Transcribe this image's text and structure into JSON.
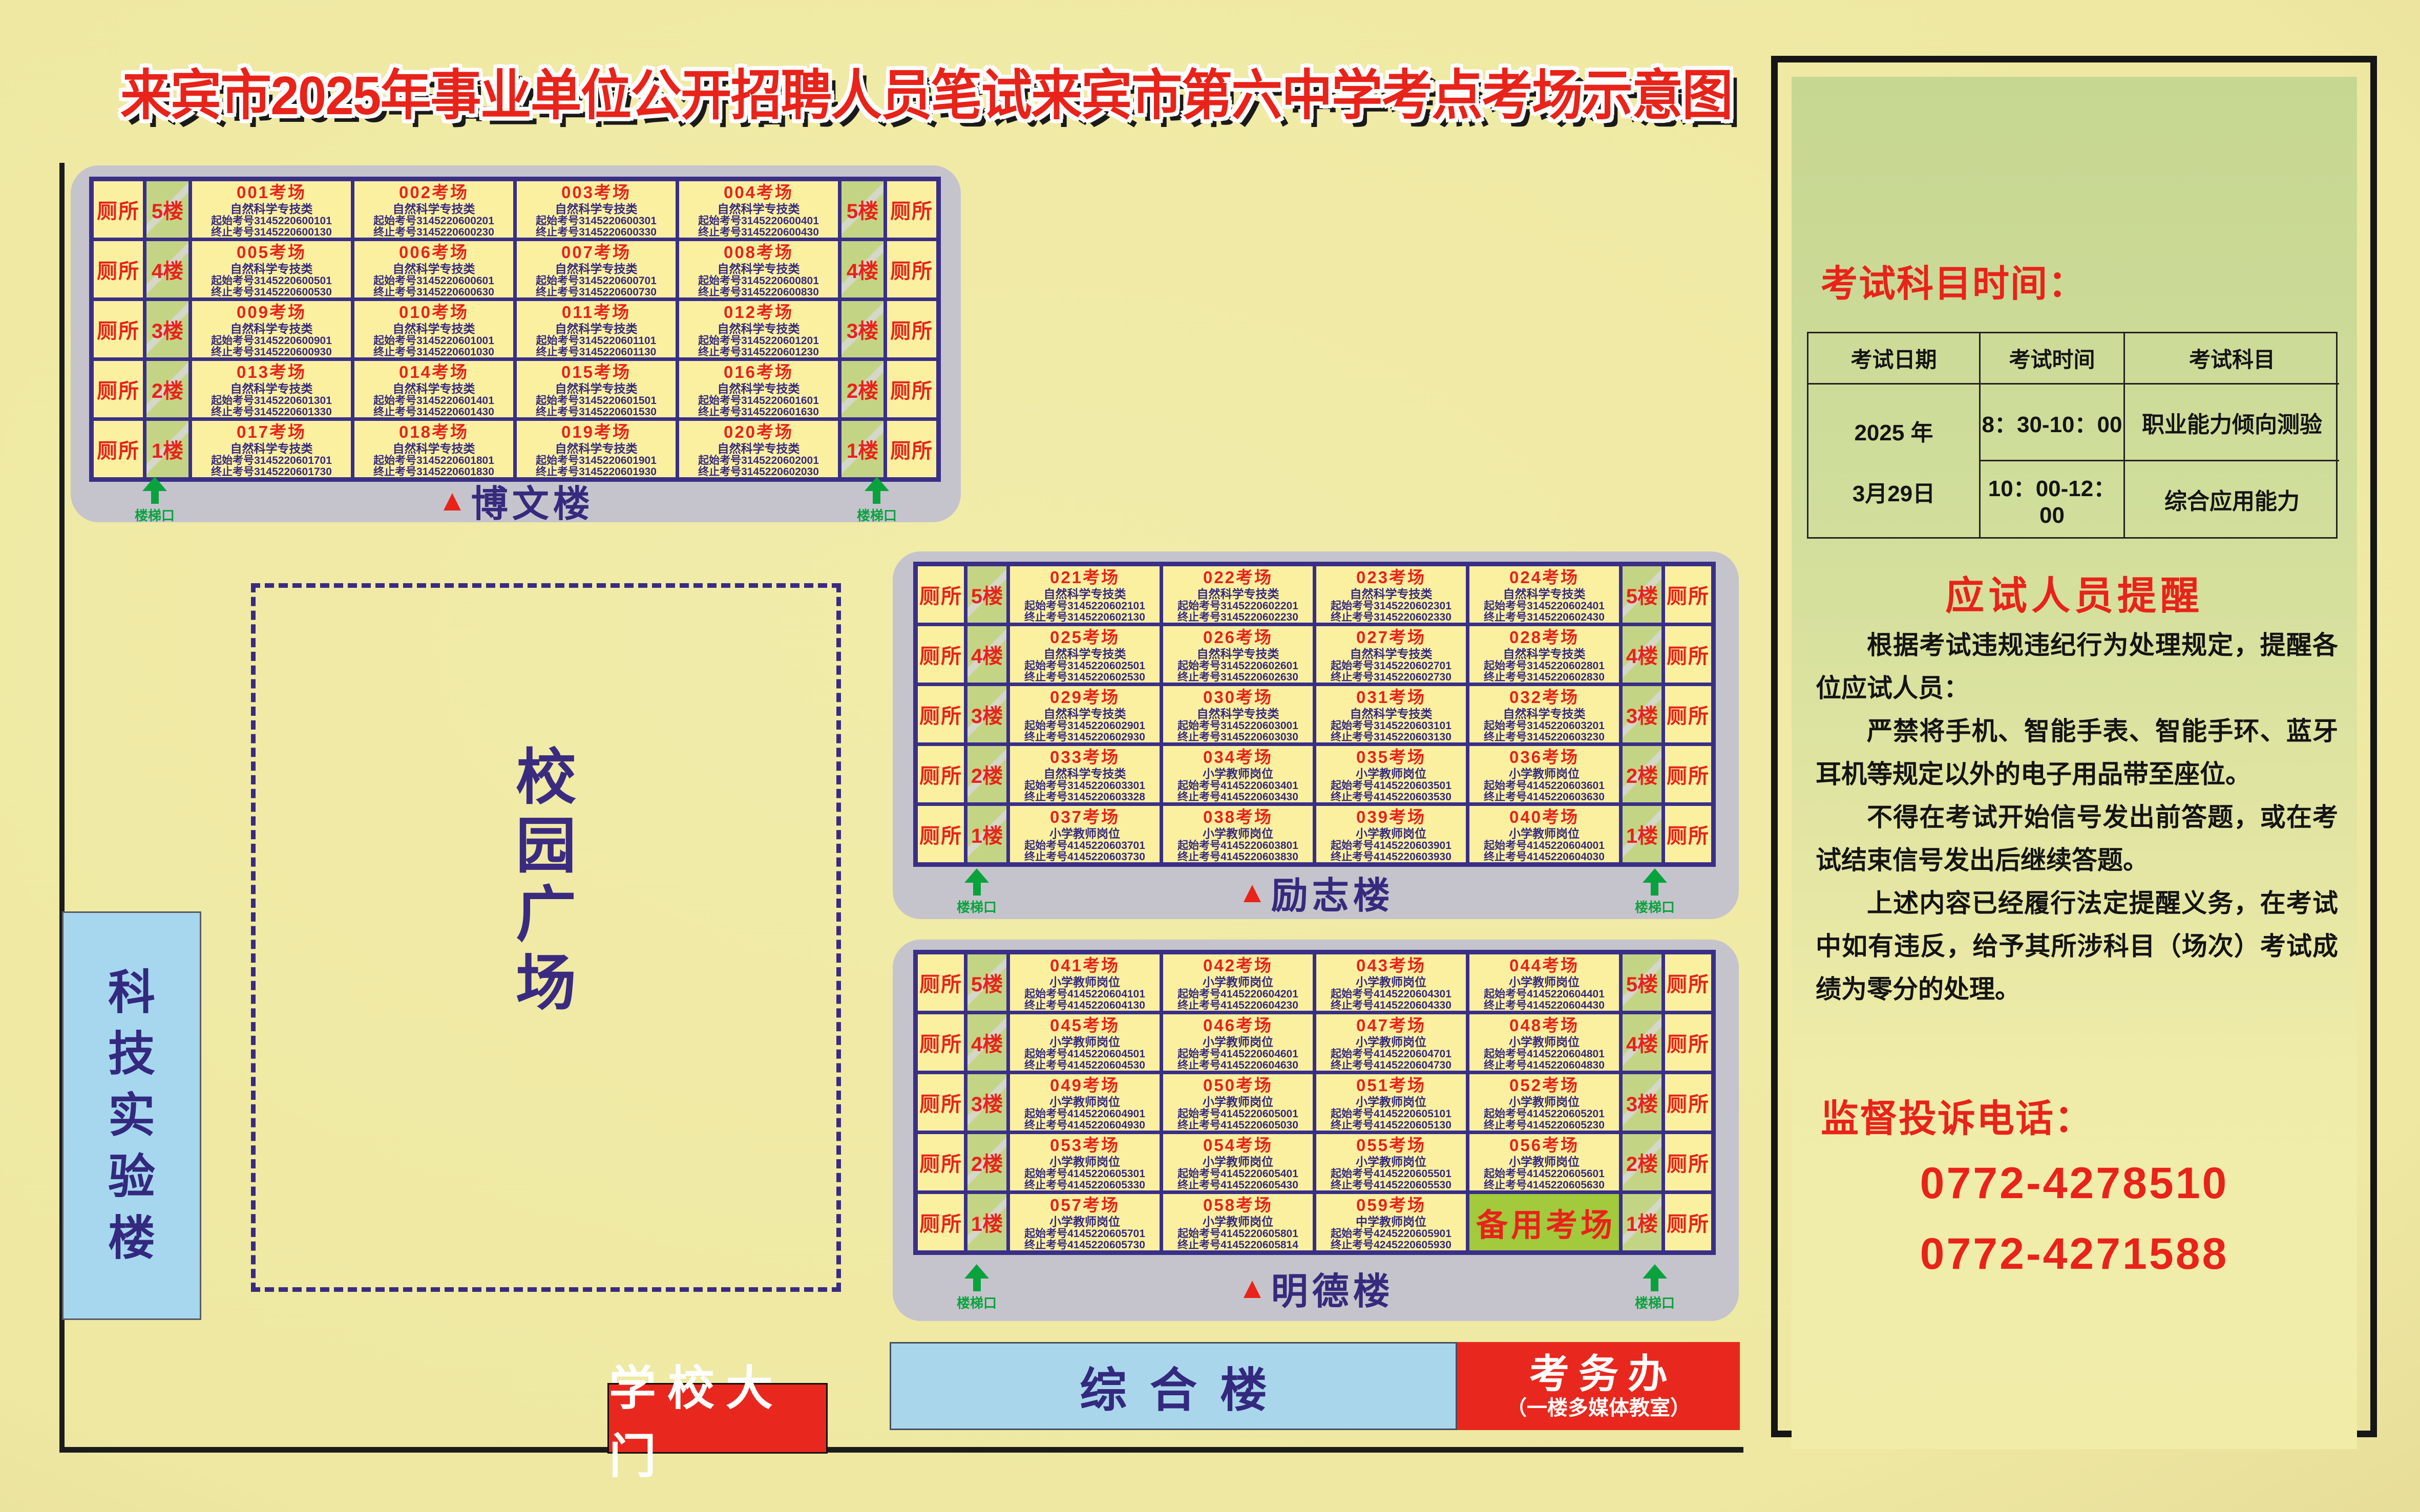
{
  "title": "来宾市2025年事业单位公开招聘人员笔试来宾市第六中学考点考场示意图",
  "map": {
    "plaza_label": "校园广场",
    "science_building_label": "科技实验楼",
    "gate_label": "学校大门",
    "complex_label": "综合楼",
    "exam_office_label": "考务办",
    "exam_office_sub": "（一楼多媒体教室）",
    "toilet_label": "厕所",
    "stair_label": "楼梯口",
    "reserve_room_label": "备用考场",
    "building_marker": "▲"
  },
  "colors": {
    "accent_red": "#e8231a",
    "navy": "#352a7d",
    "cell_yellow": "#fbf0a0",
    "stair_green": "#c3d584",
    "reserve_green": "#a2ca3c",
    "building_gray": "#c5c4cc",
    "arrow_green": "#0aa23d",
    "blue_building": "#aad6ec",
    "panel_green": "#c6d791"
  },
  "buildings": [
    {
      "name": "博文楼",
      "floors": [
        {
          "label": "5楼",
          "rooms": [
            {
              "num": "001考场",
              "cat": "自然科学专技类",
              "start": "起始考号3145220600101",
              "end": "终止考号3145220600130"
            },
            {
              "num": "002考场",
              "cat": "自然科学专技类",
              "start": "起始考号3145220600201",
              "end": "终止考号3145220600230"
            },
            {
              "num": "003考场",
              "cat": "自然科学专技类",
              "start": "起始考号3145220600301",
              "end": "终止考号3145220600330"
            },
            {
              "num": "004考场",
              "cat": "自然科学专技类",
              "start": "起始考号3145220600401",
              "end": "终止考号3145220600430"
            }
          ]
        },
        {
          "label": "4楼",
          "rooms": [
            {
              "num": "005考场",
              "cat": "自然科学专技类",
              "start": "起始考号3145220600501",
              "end": "终止考号3145220600530"
            },
            {
              "num": "006考场",
              "cat": "自然科学专技类",
              "start": "起始考号3145220600601",
              "end": "终止考号3145220600630"
            },
            {
              "num": "007考场",
              "cat": "自然科学专技类",
              "start": "起始考号3145220600701",
              "end": "终止考号3145220600730"
            },
            {
              "num": "008考场",
              "cat": "自然科学专技类",
              "start": "起始考号3145220600801",
              "end": "终止考号3145220600830"
            }
          ]
        },
        {
          "label": "3楼",
          "rooms": [
            {
              "num": "009考场",
              "cat": "自然科学专技类",
              "start": "起始考号3145220600901",
              "end": "终止考号3145220600930"
            },
            {
              "num": "010考场",
              "cat": "自然科学专技类",
              "start": "起始考号3145220601001",
              "end": "终止考号3145220601030"
            },
            {
              "num": "011考场",
              "cat": "自然科学专技类",
              "start": "起始考号3145220601101",
              "end": "终止考号3145220601130"
            },
            {
              "num": "012考场",
              "cat": "自然科学专技类",
              "start": "起始考号3145220601201",
              "end": "终止考号3145220601230"
            }
          ]
        },
        {
          "label": "2楼",
          "rooms": [
            {
              "num": "013考场",
              "cat": "自然科学专技类",
              "start": "起始考号3145220601301",
              "end": "终止考号3145220601330"
            },
            {
              "num": "014考场",
              "cat": "自然科学专技类",
              "start": "起始考号3145220601401",
              "end": "终止考号3145220601430"
            },
            {
              "num": "015考场",
              "cat": "自然科学专技类",
              "start": "起始考号3145220601501",
              "end": "终止考号3145220601530"
            },
            {
              "num": "016考场",
              "cat": "自然科学专技类",
              "start": "起始考号3145220601601",
              "end": "终止考号3145220601630"
            }
          ]
        },
        {
          "label": "1楼",
          "rooms": [
            {
              "num": "017考场",
              "cat": "自然科学专技类",
              "start": "起始考号3145220601701",
              "end": "终止考号3145220601730"
            },
            {
              "num": "018考场",
              "cat": "自然科学专技类",
              "start": "起始考号3145220601801",
              "end": "终止考号3145220601830"
            },
            {
              "num": "019考场",
              "cat": "自然科学专技类",
              "start": "起始考号3145220601901",
              "end": "终止考号3145220601930"
            },
            {
              "num": "020考场",
              "cat": "自然科学专技类",
              "start": "起始考号3145220602001",
              "end": "终止考号3145220602030"
            }
          ]
        }
      ]
    },
    {
      "name": "励志楼",
      "floors": [
        {
          "label": "5楼",
          "rooms": [
            {
              "num": "021考场",
              "cat": "自然科学专技类",
              "start": "起始考号3145220602101",
              "end": "终止考号3145220602130"
            },
            {
              "num": "022考场",
              "cat": "自然科学专技类",
              "start": "起始考号3145220602201",
              "end": "终止考号3145220602230"
            },
            {
              "num": "023考场",
              "cat": "自然科学专技类",
              "start": "起始考号3145220602301",
              "end": "终止考号3145220602330"
            },
            {
              "num": "024考场",
              "cat": "自然科学专技类",
              "start": "起始考号3145220602401",
              "end": "终止考号3145220602430"
            }
          ]
        },
        {
          "label": "4楼",
          "rooms": [
            {
              "num": "025考场",
              "cat": "自然科学专技类",
              "start": "起始考号3145220602501",
              "end": "终止考号3145220602530"
            },
            {
              "num": "026考场",
              "cat": "自然科学专技类",
              "start": "起始考号3145220602601",
              "end": "终止考号3145220602630"
            },
            {
              "num": "027考场",
              "cat": "自然科学专技类",
              "start": "起始考号3145220602701",
              "end": "终止考号3145220602730"
            },
            {
              "num": "028考场",
              "cat": "自然科学专技类",
              "start": "起始考号3145220602801",
              "end": "终止考号3145220602830"
            }
          ]
        },
        {
          "label": "3楼",
          "rooms": [
            {
              "num": "029考场",
              "cat": "自然科学专技类",
              "start": "起始考号3145220602901",
              "end": "终止考号3145220602930"
            },
            {
              "num": "030考场",
              "cat": "自然科学专技类",
              "start": "起始考号3145220603001",
              "end": "终止考号3145220603030"
            },
            {
              "num": "031考场",
              "cat": "自然科学专技类",
              "start": "起始考号3145220603101",
              "end": "终止考号3145220603130"
            },
            {
              "num": "032考场",
              "cat": "自然科学专技类",
              "start": "起始考号3145220603201",
              "end": "终止考号3145220603230"
            }
          ]
        },
        {
          "label": "2楼",
          "rooms": [
            {
              "num": "033考场",
              "cat": "自然科学专技类",
              "start": "起始考号3145220603301",
              "end": "终止考号3145220603328"
            },
            {
              "num": "034考场",
              "cat": "小学教师岗位",
              "start": "起始考号4145220603401",
              "end": "终止考号4145220603430"
            },
            {
              "num": "035考场",
              "cat": "小学教师岗位",
              "start": "起始考号4145220603501",
              "end": "终止考号4145220603530"
            },
            {
              "num": "036考场",
              "cat": "小学教师岗位",
              "start": "起始考号4145220603601",
              "end": "终止考号4145220603630"
            }
          ]
        },
        {
          "label": "1楼",
          "rooms": [
            {
              "num": "037考场",
              "cat": "小学教师岗位",
              "start": "起始考号4145220603701",
              "end": "终止考号4145220603730"
            },
            {
              "num": "038考场",
              "cat": "小学教师岗位",
              "start": "起始考号4145220603801",
              "end": "终止考号4145220603830"
            },
            {
              "num": "039考场",
              "cat": "小学教师岗位",
              "start": "起始考号4145220603901",
              "end": "终止考号4145220603930"
            },
            {
              "num": "040考场",
              "cat": "小学教师岗位",
              "start": "起始考号4145220604001",
              "end": "终止考号4145220604030"
            }
          ]
        }
      ]
    },
    {
      "name": "明德楼",
      "floors": [
        {
          "label": "5楼",
          "rooms": [
            {
              "num": "041考场",
              "cat": "小学教师岗位",
              "start": "起始考号4145220604101",
              "end": "终止考号4145220604130"
            },
            {
              "num": "042考场",
              "cat": "小学教师岗位",
              "start": "起始考号4145220604201",
              "end": "终止考号4145220604230"
            },
            {
              "num": "043考场",
              "cat": "小学教师岗位",
              "start": "起始考号4145220604301",
              "end": "终止考号4145220604330"
            },
            {
              "num": "044考场",
              "cat": "小学教师岗位",
              "start": "起始考号4145220604401",
              "end": "终止考号4145220604430"
            }
          ]
        },
        {
          "label": "4楼",
          "rooms": [
            {
              "num": "045考场",
              "cat": "小学教师岗位",
              "start": "起始考号4145220604501",
              "end": "终止考号4145220604530"
            },
            {
              "num": "046考场",
              "cat": "小学教师岗位",
              "start": "起始考号4145220604601",
              "end": "终止考号4145220604630"
            },
            {
              "num": "047考场",
              "cat": "小学教师岗位",
              "start": "起始考号4145220604701",
              "end": "终止考号4145220604730"
            },
            {
              "num": "048考场",
              "cat": "小学教师岗位",
              "start": "起始考号4145220604801",
              "end": "终止考号4145220604830"
            }
          ]
        },
        {
          "label": "3楼",
          "rooms": [
            {
              "num": "049考场",
              "cat": "小学教师岗位",
              "start": "起始考号4145220604901",
              "end": "终止考号4145220604930"
            },
            {
              "num": "050考场",
              "cat": "小学教师岗位",
              "start": "起始考号4145220605001",
              "end": "终止考号4145220605030"
            },
            {
              "num": "051考场",
              "cat": "小学教师岗位",
              "start": "起始考号4145220605101",
              "end": "终止考号4145220605130"
            },
            {
              "num": "052考场",
              "cat": "小学教师岗位",
              "start": "起始考号4145220605201",
              "end": "终止考号4145220605230"
            }
          ]
        },
        {
          "label": "2楼",
          "rooms": [
            {
              "num": "053考场",
              "cat": "小学教师岗位",
              "start": "起始考号4145220605301",
              "end": "终止考号4145220605330"
            },
            {
              "num": "054考场",
              "cat": "小学教师岗位",
              "start": "起始考号4145220605401",
              "end": "终止考号4145220605430"
            },
            {
              "num": "055考场",
              "cat": "小学教师岗位",
              "start": "起始考号4145220605501",
              "end": "终止考号4145220605530"
            },
            {
              "num": "056考场",
              "cat": "小学教师岗位",
              "start": "起始考号4145220605601",
              "end": "终止考号4145220605630"
            }
          ]
        },
        {
          "label": "1楼",
          "rooms": [
            {
              "num": "057考场",
              "cat": "小学教师岗位",
              "start": "起始考号4145220605701",
              "end": "终止考号4145220605730"
            },
            {
              "num": "058考场",
              "cat": "小学教师岗位",
              "start": "起始考号4145220605801",
              "end": "终止考号4145220605814"
            },
            {
              "num": "059考场",
              "cat": "中学教师岗位",
              "start": "起始考号4245220605901",
              "end": "终止考号4245220605930"
            },
            {
              "reserve": true
            }
          ]
        }
      ]
    }
  ],
  "panel": {
    "schedule_heading": "考试科目时间：",
    "table": {
      "headers": [
        "考试日期",
        "考试时间",
        "考试科目"
      ],
      "date_lines": [
        "2025 年",
        "3月29日"
      ],
      "rows": [
        {
          "time": "8：30-10：00",
          "subject": "职业能力倾向测验"
        },
        {
          "time": "10：00-12：00",
          "subject": "综合应用能力"
        }
      ]
    },
    "reminder_heading": "应试人员提醒",
    "paragraphs": [
      "根据考试违规违纪行为处理规定，提醒各位应试人员：",
      "严禁将手机、智能手表、智能手环、蓝牙耳机等规定以外的电子用品带至座位。",
      "不得在考试开始信号发出前答题，或在考试结束信号发出后继续答题。",
      "上述内容已经履行法定提醒义务，在考试中如有违反，给予其所涉科目（场次）考试成绩为零分的处理。"
    ],
    "complaint_heading": "监督投诉电话：",
    "phones": [
      "0772-4278510",
      "0772-4271588"
    ]
  }
}
